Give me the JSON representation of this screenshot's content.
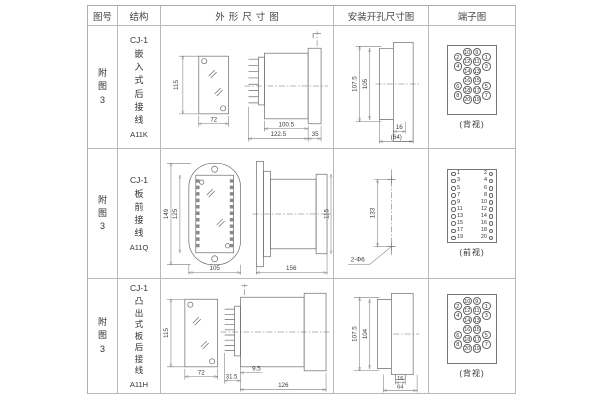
{
  "table": {
    "headers": {
      "figure": "图号",
      "structure": "结构",
      "outline": "外形尺寸图",
      "install": "安装开孔尺寸图",
      "terminal": "端子图"
    }
  },
  "rows": [
    {
      "figure": "附图3",
      "model": "CJ-1",
      "mount": "嵌入式后接线",
      "code": "A11K",
      "outline": {
        "front_height": "115",
        "front_width": "72",
        "d1": "100.5",
        "d2": "122.5",
        "d3": "35"
      },
      "install": {
        "v1": "107.5",
        "v2": "105",
        "h1": "16",
        "h2": "(64)"
      },
      "terminal": {
        "caption": "(背视)",
        "outer_left": [
          "2",
          "4",
          "6",
          "8"
        ],
        "inner_left": [
          "10",
          "12",
          "14",
          "16",
          "18",
          "20"
        ],
        "inner_right": [
          "9",
          "11",
          "13",
          "15",
          "17",
          "19"
        ],
        "outer_right": [
          "1",
          "3",
          "5",
          "7"
        ]
      }
    },
    {
      "figure": "附图3",
      "model": "CJ-1",
      "mount": "板前接线",
      "code": "A11Q",
      "outline": {
        "front_height": "149",
        "front_inner": "125",
        "front_width": "105",
        "side_length": "156",
        "side_height": "115"
      },
      "install": {
        "v1": "133",
        "hole_label": "2-Φ6"
      },
      "terminal": {
        "caption": "(前视)",
        "pairs": [
          {
            "l": "1",
            "r": "2"
          },
          {
            "l": "3",
            "r": "4"
          },
          {
            "l": "5",
            "r": "6"
          },
          {
            "l": "7",
            "r": "8"
          },
          {
            "l": "9",
            "r": "10"
          },
          {
            "l": "11",
            "r": "12"
          },
          {
            "l": "13",
            "r": "14"
          },
          {
            "l": "15",
            "r": "16"
          },
          {
            "l": "17",
            "r": "18"
          },
          {
            "l": "19",
            "r": "20"
          }
        ]
      }
    },
    {
      "figure": "附图3",
      "model": "CJ-1",
      "mount": "凸出式板后接线",
      "code": "A11H",
      "outline": {
        "front_height": "115",
        "front_width": "72",
        "d1": "31.5",
        "d2": "9.5",
        "d3": "126"
      },
      "install": {
        "v1": "107.5",
        "v2": "104",
        "h1": "16",
        "h2": "64"
      },
      "terminal": {
        "caption": "(背视)",
        "outer_left": [
          "2",
          "4",
          "6",
          "8"
        ],
        "inner_left": [
          "10",
          "12",
          "14",
          "16",
          "18",
          "20"
        ],
        "inner_right": [
          "9",
          "11",
          "13",
          "15",
          "17",
          "19"
        ],
        "outer_right": [
          "1",
          "3",
          "5",
          "7"
        ]
      }
    }
  ]
}
